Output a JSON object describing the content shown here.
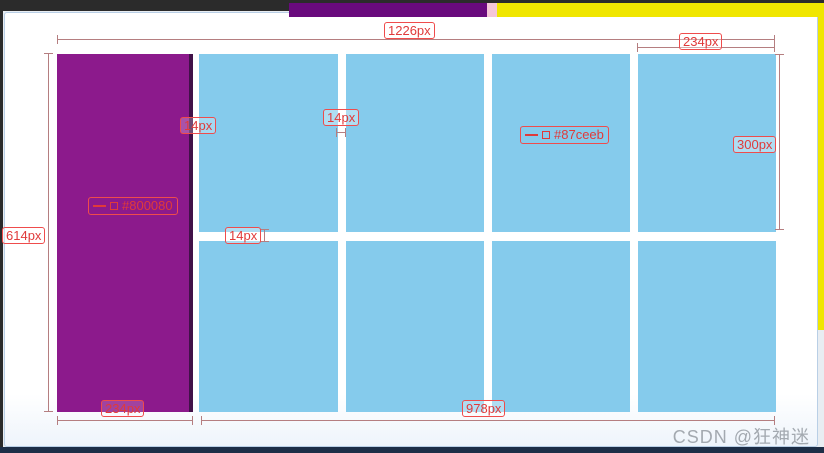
{
  "page": {
    "watermark": "CSDN @狂神迷"
  },
  "palette": {
    "sidebar_purple": "#8c1a8c",
    "grid_blue": "#85cbec",
    "annotation_red": "#e03a3a",
    "dimension_line": "#b57e80",
    "top_strip_purple": "#690a7d",
    "top_strip_pink": "#f5c6d8",
    "top_strip_yellow": "#f0e600",
    "chrome_dark": "#2b2b2b",
    "bottom_bar_navy": "#1d2e47"
  },
  "dimensions": {
    "total_width": "1226px",
    "column_width": "234px",
    "left_height": "614px",
    "box_height": "300px",
    "gap_after_sidebar": "14px",
    "column_gap": "14px",
    "row_gap": "14px",
    "sidebar_width": "234px",
    "content_width": "978px"
  },
  "color_labels": {
    "sidebar": "#800080",
    "box": "#87ceeb"
  }
}
